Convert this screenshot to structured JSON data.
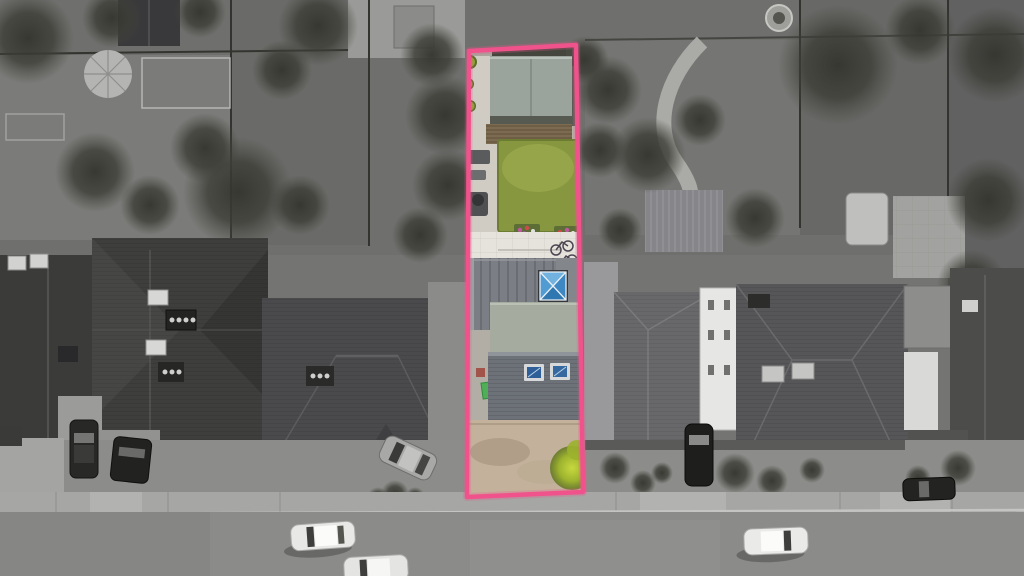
{
  "image": {
    "kind": "aerial-property-photograph",
    "effect": "surroundings desaturated to grayscale; plot inside boundary shown in full colour"
  },
  "boundary": {
    "stroke_color": "#f0538b",
    "points": "469,51 576,45 583,492 467,497"
  },
  "palette": {
    "accent-pink": "#f0538b",
    "lawn-green": "#879740",
    "lawn-light": "#9aa84c",
    "garden-roof-sage": "#9aa39c",
    "flat-roof-sage": "#a5ac9f",
    "deck-brown": "#7c6b51",
    "patio-white": "#e6e3dc",
    "extension-gray": "#7b7f85",
    "pitched-roof-gray": "#6d7178",
    "lantern-blue": "#4f9bd2",
    "skylight-blue": "#2f5f98",
    "driveway-tan": "#c3b19c",
    "bush-yellow-green": "#a9be35",
    "bin-green": "#4fae57",
    "path-light": "#d0ccc4"
  }
}
